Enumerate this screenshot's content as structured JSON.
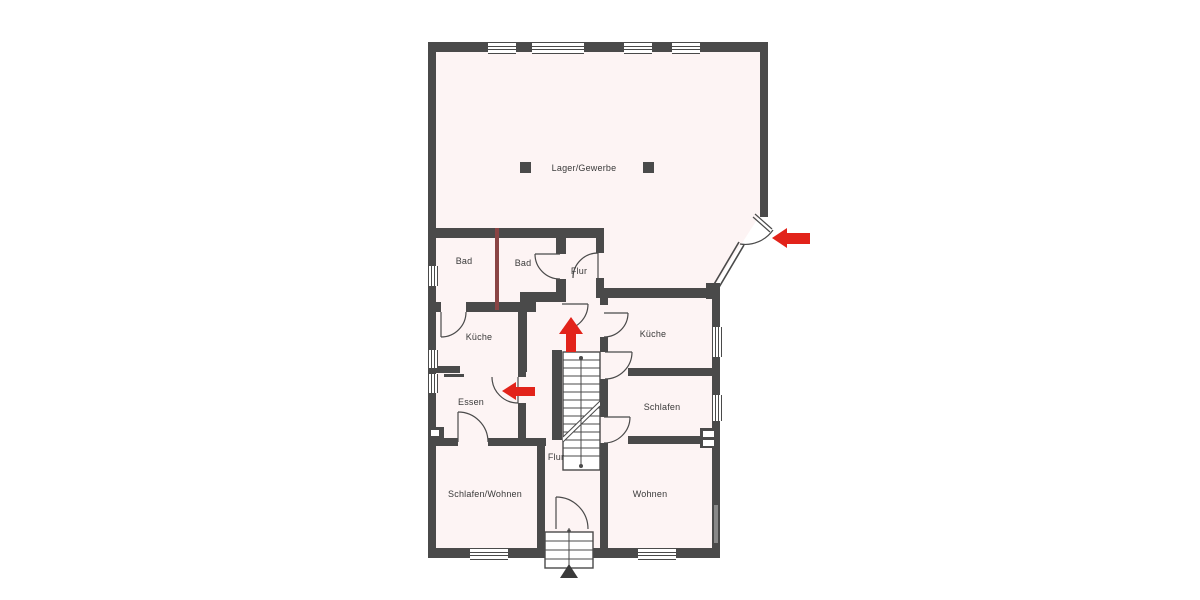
{
  "plan": {
    "rooms": {
      "lager": "Lager/Gewerbe",
      "bad_left": "Bad",
      "bad_right": "Bad",
      "flur_upper": "Flur",
      "kueche_left": "Küche",
      "kueche_right": "Küche",
      "essen": "Essen",
      "schlafen": "Schlafen",
      "flur_lower": "Flur",
      "schlafen_wohnen": "Schlafen/Wohnen",
      "wohnen": "Wohnen"
    },
    "colors": {
      "wall": "#4a4a4a",
      "floor": "#fdf4f4",
      "arrow": "#e2231a",
      "partition": "#8a4444"
    }
  }
}
